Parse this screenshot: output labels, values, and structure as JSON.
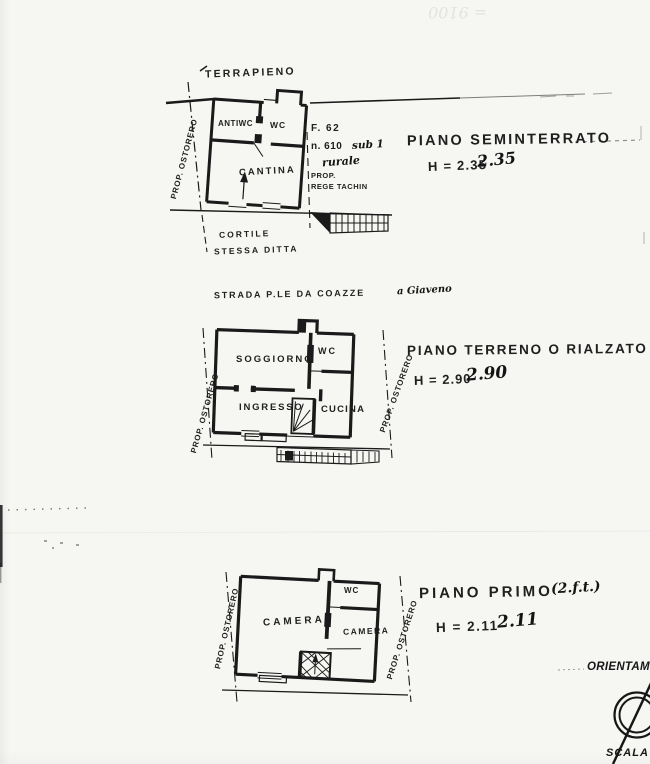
{
  "artifacts": {
    "bleed_text": "= 9100"
  },
  "plan1": {
    "terrain_label": "TERRAPIENO",
    "prop_left": "PROP. OSTORERO",
    "rooms": {
      "antiwc": "ANTIWC",
      "wc": "WC",
      "cantina": "CANTINA"
    },
    "parcel": {
      "sheet": "F. 62",
      "number": "n. 610",
      "sub": "sub 1",
      "note": "rurale",
      "owner_label": "PROP.",
      "owner_name": "REGE TACHIN"
    },
    "courtyard_line1": "CORTILE",
    "courtyard_line2": "STESSA DITTA",
    "title": "PIANO SEMINTERRATO",
    "height": "H = 2.35",
    "height_hand": "2.35"
  },
  "plan2": {
    "street_label": "STRADA P.LE DA COAZZE",
    "street_hand": "a Giaveno",
    "prop_left": "PROP. OSTORERO",
    "prop_right": "PROP. OSTORERO",
    "rooms": {
      "soggiorno": "SOGGIORNO",
      "wc": "WC",
      "ingresso": "INGRESSO",
      "cucina": "CUCINA"
    },
    "title": "PIANO TERRENO O RIALZATO",
    "height": "H = 2.90",
    "height_hand": "2.90"
  },
  "plan3": {
    "prop_left": "PROP. OSTORERO",
    "prop_right": "PROP. OSTORERO",
    "rooms": {
      "camera_left": "CAMERA",
      "wc": "WC",
      "camera_right": "CAMERA"
    },
    "title": "PIANO PRIMO",
    "title_hand": "(2.f.t.)",
    "height": "H = 2.11",
    "height_hand": "2.11"
  },
  "footer": {
    "orientation_label": "ORIENTAM",
    "scale_label": "SCALA 1"
  }
}
